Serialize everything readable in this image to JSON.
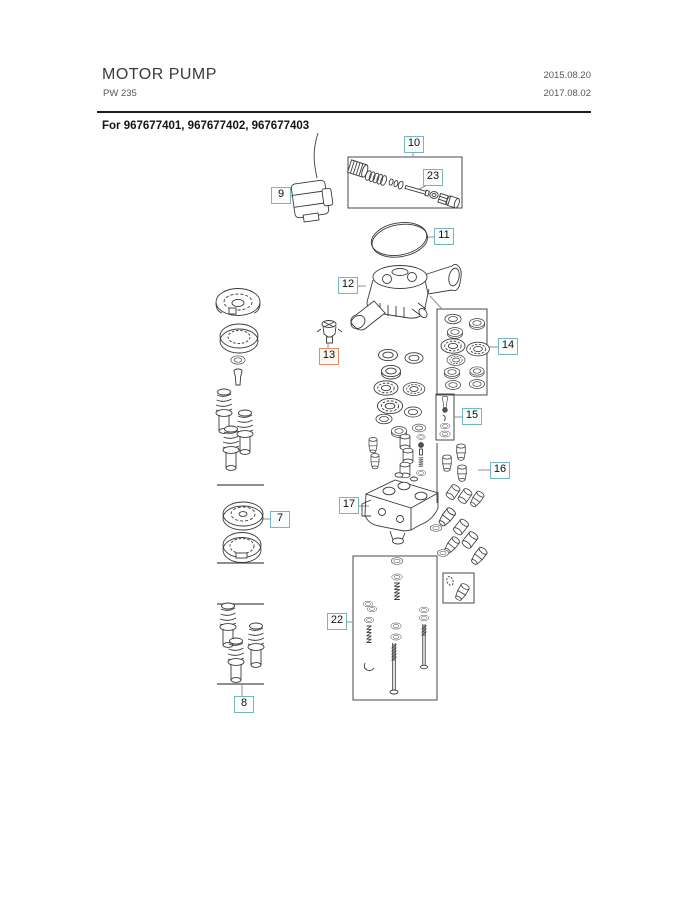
{
  "header": {
    "title": "MOTOR PUMP",
    "model": "PW 235",
    "date_line1": "2015.08.20",
    "date_line2": "2017.08.02"
  },
  "applies_to": "For 967677401, 967677402, 967677403",
  "callouts": [
    {
      "label": "7",
      "style": "teal"
    },
    {
      "label": "8",
      "style": "teal"
    },
    {
      "label": "9",
      "style": "teal"
    },
    {
      "label": "10",
      "style": "teal"
    },
    {
      "label": "11",
      "style": "teal"
    },
    {
      "label": "12",
      "style": "teal"
    },
    {
      "label": "13",
      "style": "orange"
    },
    {
      "label": "14",
      "style": "teal"
    },
    {
      "label": "15",
      "style": "teal"
    },
    {
      "label": "16",
      "style": "teal"
    },
    {
      "label": "17",
      "style": "teal"
    },
    {
      "label": "22",
      "style": "teal"
    },
    {
      "label": "23",
      "style": "teal"
    }
  ],
  "colors": {
    "callout_border": "#74b7c0",
    "callout_border_highlight": "#d8906c",
    "drawing_line": "#3b3b3b",
    "leader_line": "#8f8f8f",
    "rule": "#1c1c1c"
  }
}
